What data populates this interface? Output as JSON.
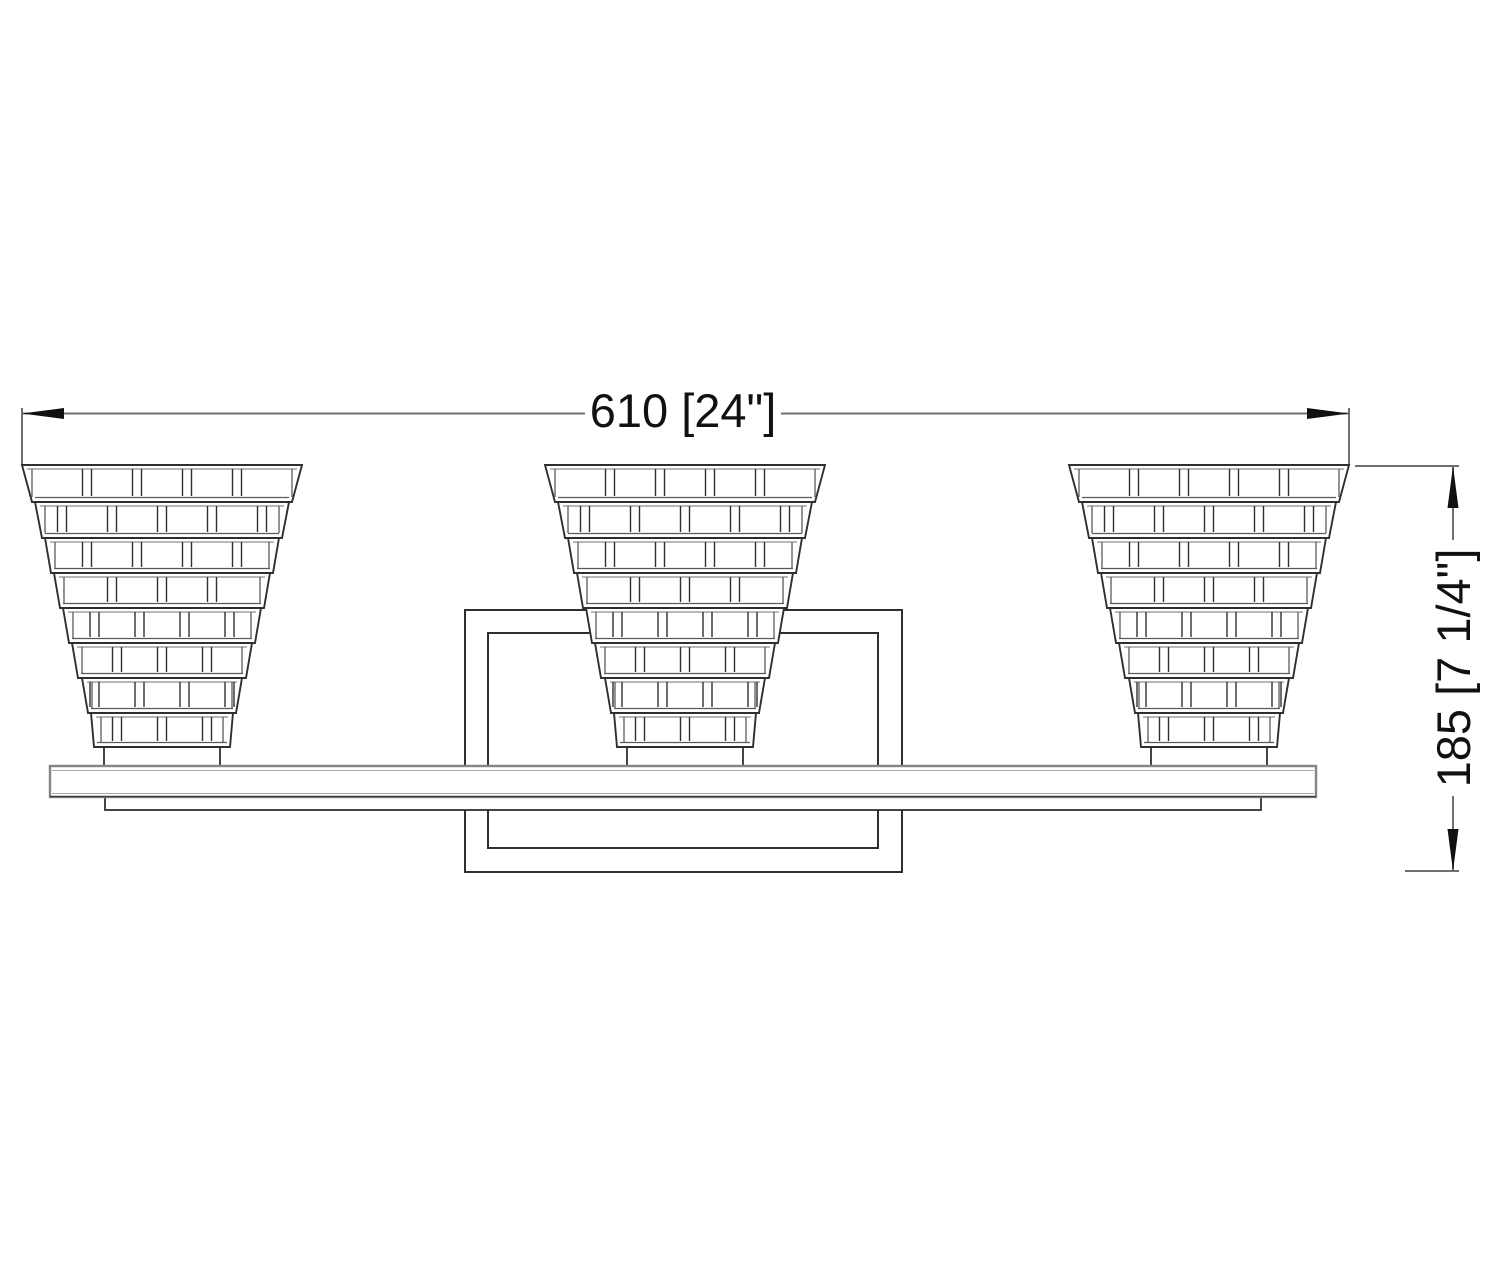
{
  "drawing": {
    "type": "dimension-drawing",
    "colors": {
      "line": "#2f2f2f",
      "soft_line": "#5a5a5a",
      "rim_line": "#8d8d8d",
      "bar_line": "#858585",
      "bar_inner_line": "#a8a8a8",
      "dim_line": "#6f6f6f",
      "text": "#111111",
      "background": "#ffffff"
    },
    "dimensions": {
      "width": {
        "label": "610 [24\"]",
        "mm": 610,
        "inches": "24\""
      },
      "height": {
        "label": "185 [7 1/4\"]",
        "mm": 185,
        "inches": "7 1/4\""
      }
    },
    "fixture": {
      "shade_count": 3,
      "tiers_per_shade": 8
    }
  }
}
